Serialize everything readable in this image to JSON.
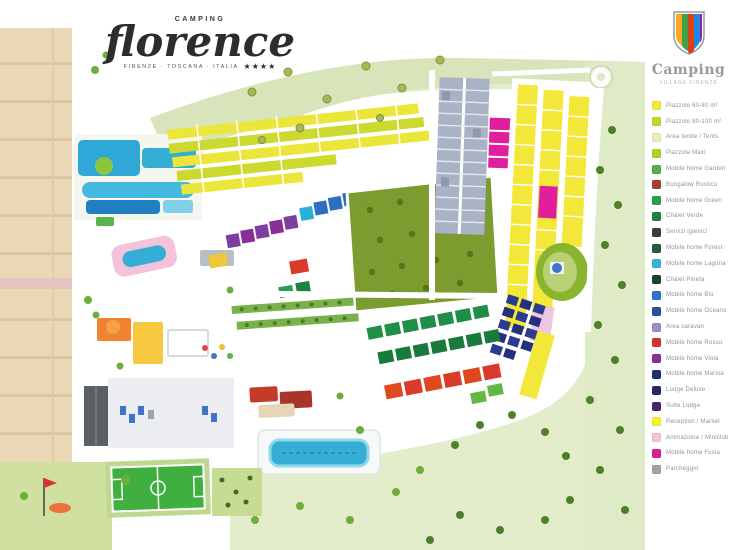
{
  "logo": {
    "top": "CAMPING",
    "name": "florence",
    "sub": "firenze · toscana · italia",
    "stars": "★★★★"
  },
  "sidebar": {
    "brand": "Camping",
    "brand_sub": "Village Firenze",
    "legend": {
      "items": [
        {
          "label": "Piazzole 60-80 m²",
          "color": "#f1e93d"
        },
        {
          "label": "Piazzole 80-100 m²",
          "color": "#c3d629"
        },
        {
          "label": "Area tende / Tents",
          "color": "#e9efbc"
        },
        {
          "label": "Piazzole Maxi",
          "color": "#aad426"
        },
        {
          "label": "Mobile home Garden",
          "color": "#56b14b"
        },
        {
          "label": "Bungalow Rustico",
          "color": "#a6402e"
        },
        {
          "label": "Mobile home Green",
          "color": "#2d9e51"
        },
        {
          "label": "Chalet Verde",
          "color": "#20803f"
        },
        {
          "label": "Servizi igienici",
          "color": "#3b3f33"
        },
        {
          "label": "Mobile home Forest",
          "color": "#2a5a3a"
        },
        {
          "label": "Mobile home Laguna",
          "color": "#39b3dc"
        },
        {
          "label": "Chalet Pineta",
          "color": "#1d4426"
        },
        {
          "label": "Mobile home Blu",
          "color": "#2f72c6"
        },
        {
          "label": "Mobile home Oceano",
          "color": "#2c4f9e"
        },
        {
          "label": "Area caravan",
          "color": "#9b8fc6"
        },
        {
          "label": "Mobile home Rosso",
          "color": "#d5342e"
        },
        {
          "label": "Mobile home Viola",
          "color": "#8a2f99"
        },
        {
          "label": "Mobile home Marina",
          "color": "#1d2f74"
        },
        {
          "label": "Lodge Deluxe",
          "color": "#262a63"
        },
        {
          "label": "Suite Lodge",
          "color": "#4c2374"
        },
        {
          "label": "Reception / Market",
          "color": "#f4f22f"
        },
        {
          "label": "Animazione / Miniclub",
          "color": "#f4c6d6"
        },
        {
          "label": "Mobile home Fuxia",
          "color": "#da1f90"
        },
        {
          "label": "Parcheggio",
          "color": "#a3a3a3"
        }
      ]
    }
  },
  "map": {
    "palette": {
      "hill_green": "#dde9c2",
      "beach_sand": "#e9d7b5",
      "pitch_yellow": "#ede63a",
      "pitch_chartreuse": "#ccd92e",
      "field_olive": "#7d9c2f",
      "water_blue": "#35aed6",
      "parking_gray": "#aab3c5",
      "magenta": "#df1f9d",
      "navy": "#2b3b90",
      "red_unit": "#d93a2b"
    }
  }
}
